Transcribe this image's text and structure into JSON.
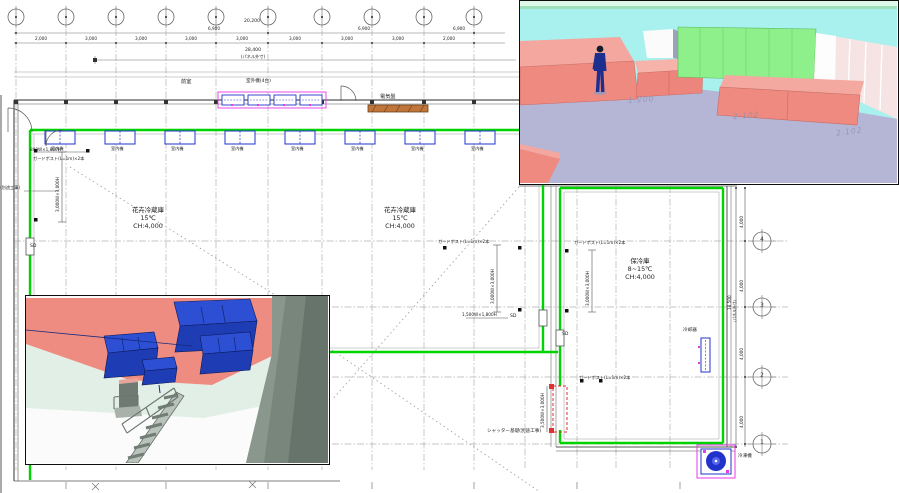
{
  "drawing": {
    "rooms": [
      {
        "name": "花卉冷蔵庫",
        "temp": "15℃",
        "ch": "CH:4,000"
      },
      {
        "name": "花卉冷蔵庫",
        "temp": "15℃",
        "ch": "CH:4,000"
      },
      {
        "name": "保冷庫",
        "temp": "8~15℃",
        "ch": "CH:4,000"
      }
    ],
    "labels": {
      "anteroom": "前室",
      "outdoor_units": "室外機(4台)",
      "electrical_panel": "電気盤",
      "indoor_unit": "室内機",
      "guard_post": "ガードポスト(L=1m)×2本",
      "separate_work": "(別途工事)",
      "shutter_base": "シャッター基礎(別途工事)",
      "cooler": "冷却器",
      "freezer": "冷凍機",
      "sd": "SD"
    },
    "dims": {
      "total_top": "28,400",
      "total_top_note": "(パネル外寸)",
      "span_upper": "20,200",
      "span": [
        "6,900",
        "6,900",
        "6,900"
      ],
      "chain": [
        "2,000",
        "3,000",
        "3,000",
        "3,000",
        "3,000",
        "3,000",
        "3,000",
        "3,000",
        "2,000"
      ],
      "right": [
        "4,000",
        "4,000",
        "4,000",
        "4,000"
      ],
      "right_total": "18,500",
      "right_total_note": "(パネル外寸)",
      "door": "800W×1,800H",
      "opening": "3,000W×3,000H",
      "opening_small": "1,500W×1,800H",
      "shutter": "3,500W×3,000H"
    },
    "grid_rows": [
      "4",
      "3",
      "2",
      "1"
    ]
  },
  "render_top": {
    "ghosts": [
      "1.200",
      "2.102",
      "2.102"
    ]
  },
  "colors": {
    "wall_green": "#00d400",
    "unit_blue": "#2233cc",
    "magenta": "#e83ae8",
    "panel_orange": "#c0763a",
    "alert_red": "#dd3333",
    "ceiling_cyan": "#a9f1ef",
    "floor_lavender": "#b5b5d6",
    "cabinet_salmon": "#ee8a80",
    "panel_green_3d": "#8df08b",
    "ceiling_pink": "#ee8c82",
    "duct_blue": "#1e3cb4"
  }
}
